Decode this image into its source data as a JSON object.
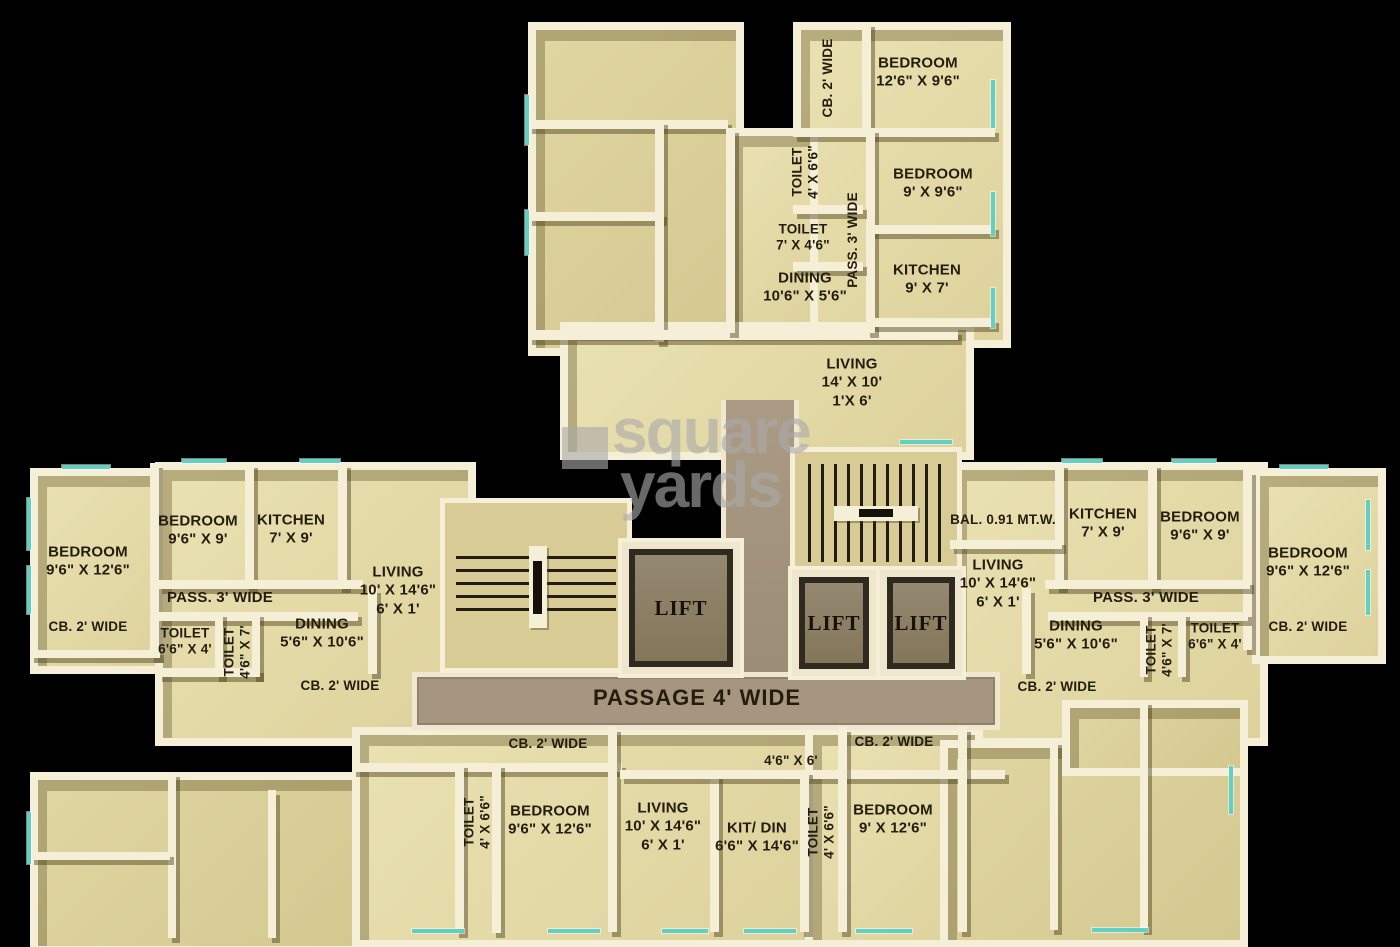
{
  "watermark": {
    "line1": "square",
    "line2": "yards"
  },
  "core": {
    "lift1": "LIFT",
    "lift2": "LIFT",
    "lift3": "LIFT",
    "passage": "PASSAGE 4' WIDE"
  },
  "top_flat": {
    "cb": "CB. 2' WIDE",
    "bedroom1": "BEDROOM\n12'6\" X 9'6\"",
    "toilet1": "TOILET\n4' X 6'6\"",
    "bedroom2": "BEDROOM\n9' X 9'6\"",
    "pass": "PASS. 3' WIDE",
    "toilet2": "TOILET\n7' X 4'6\"",
    "kitchen": "KITCHEN\n9' X 7'",
    "dining": "DINING\n10'6\" X 5'6\"",
    "living": "LIVING\n14' X 10'\n1'X 6'"
  },
  "left_flat": {
    "bedroom1": "BEDROOM\n9'6\" X 12'6\"",
    "bedroom2": "BEDROOM\n9'6\" X 9'",
    "kitchen": "KITCHEN\n7' X 9'",
    "pass": "PASS. 3' WIDE",
    "cb1": "CB. 2' WIDE",
    "toilet1": "TOILET\n6'6\" X 4'",
    "toilet2": "TOILET\n4'6\" X 7'",
    "dining": "DINING\n5'6\" X 10'6\"",
    "living": "LIVING\n10' X 14'6\"\n6' X 1'",
    "cb2": "CB. 2' WIDE"
  },
  "right_flat": {
    "balcony": "BAL. 0.91 MT.W.",
    "kitchen": "KITCHEN\n7' X 9'",
    "bedroom2": "BEDROOM\n9'6\" X 9'",
    "bedroom1": "BEDROOM\n9'6\" X 12'6\"",
    "living": "LIVING\n10' X 14'6\"\n6' X 1'",
    "pass": "PASS. 3' WIDE",
    "dining": "DINING\n5'6\" X 10'6\"",
    "toilet2": "TOILET\n4'6\" X 7'",
    "toilet1": "TOILET\n6'6\" X 4'",
    "cb1": "CB. 2' WIDE",
    "cb2": "CB. 2' WIDE"
  },
  "bottom_flat": {
    "cb1": "CB. 2' WIDE",
    "toilet1": "TOILET\n4' X 6'6\"",
    "bedroom1": "BEDROOM\n9'6\" X 12'6\"",
    "living": "LIVING\n10' X 14'6\"\n6' X 1'",
    "room": "4'6\" X 6'",
    "kitdin": "KIT/ DIN\n6'6\" X 14'6\"",
    "toilet2": "TOILET\n4' X 6'6\"",
    "cb2": "CB. 2' WIDE",
    "bedroom2": "BEDROOM\n9' X 12'6\""
  },
  "colors": {
    "background": "#000000",
    "floor": "#e5dca6",
    "wall": "#f6efd8",
    "wall_shadow": "#6b5d2e",
    "corridor": "#a6967f",
    "window": "#5fd0c2",
    "text": "#241d0d",
    "watermark": "#aaaaaa"
  }
}
